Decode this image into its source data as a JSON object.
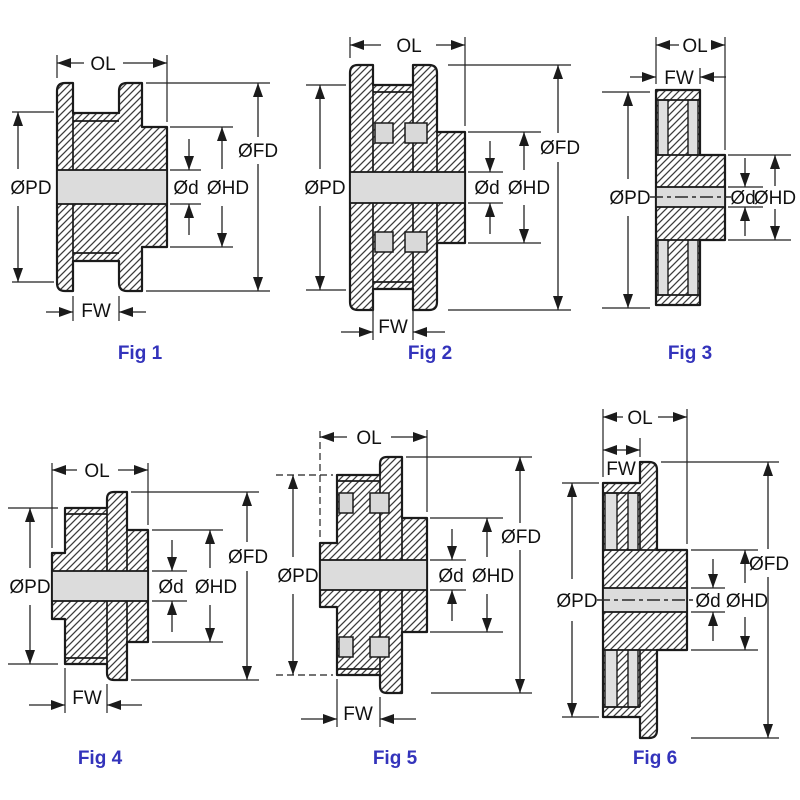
{
  "sheet": {
    "background": "#ffffff",
    "rows": 2,
    "columns": 3
  },
  "labels": {
    "ol": "OL",
    "fw": "FW",
    "pd": "ØPD",
    "fd": "ØFD",
    "hd": "ØHD",
    "d": "Ød"
  },
  "colors": {
    "caption_blue": "#3333bb",
    "outline": "#1b1b1b",
    "bore_fill": "#dcdcdc",
    "notch_fill": "#d9d9d9",
    "strip_fill": "#e0e0e0",
    "background": "#ffffff"
  },
  "figures": [
    {
      "caption": "Fig 1",
      "dim_labels": [
        "OL",
        "ØPD",
        "ØFD",
        "Ød",
        "ØHD",
        "FW"
      ]
    },
    {
      "caption": "Fig 2",
      "dim_labels": [
        "OL",
        "ØPD",
        "ØFD",
        "Ød",
        "ØHD",
        "FW"
      ]
    },
    {
      "caption": "Fig 3",
      "dim_labels": [
        "OL",
        "FW",
        "ØPD",
        "Ød",
        "ØHD"
      ]
    },
    {
      "caption": "Fig 4",
      "dim_labels": [
        "OL",
        "ØPD",
        "ØFD",
        "Ød",
        "ØHD",
        "FW"
      ]
    },
    {
      "caption": "Fig 5",
      "dim_labels": [
        "OL",
        "ØPD",
        "ØFD",
        "Ød",
        "ØHD",
        "FW"
      ]
    },
    {
      "caption": "Fig 6",
      "dim_labels": [
        "OL",
        "FW",
        "ØPD",
        "ØFD",
        "Ød",
        "ØHD"
      ]
    }
  ]
}
